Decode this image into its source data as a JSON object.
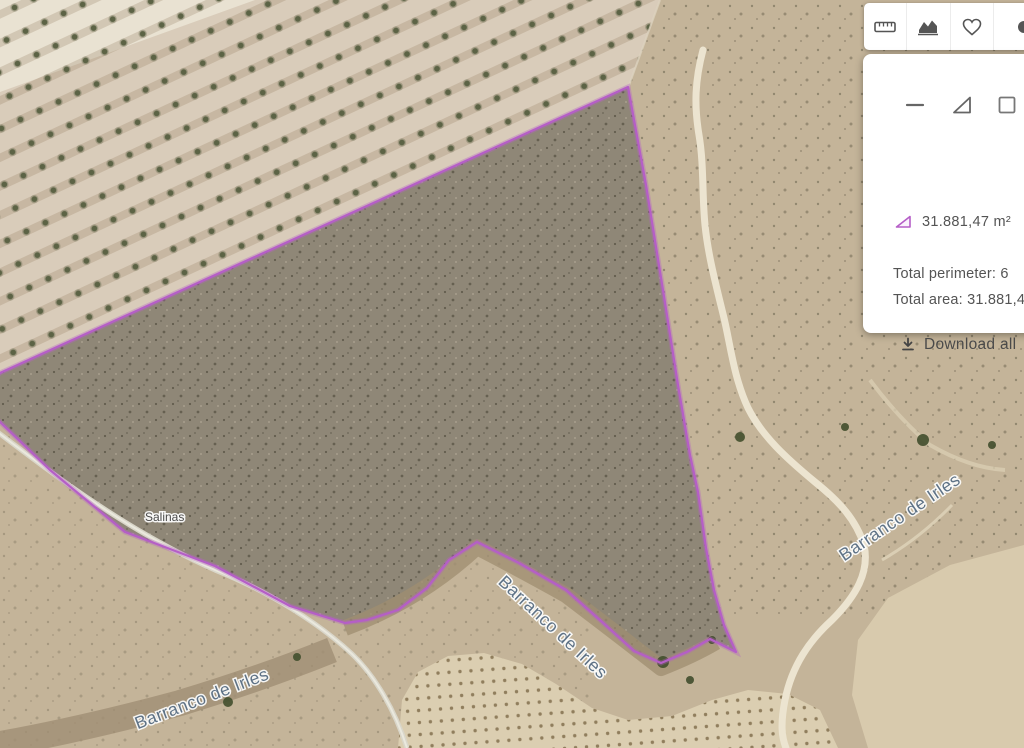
{
  "toolbar": {
    "icons": [
      "ruler-icon",
      "elevation-profile-icon",
      "favorite-heart-icon",
      "more-icon-partial"
    ]
  },
  "panel": {
    "tool_icons": [
      "line-measure-icon",
      "area-measure-icon",
      "rectangle-measure-icon"
    ],
    "measurement_value": "31.881,47 m²",
    "perimeter_text": "Total perimeter: 6",
    "area_text": "Total area: 31.881,47 m²",
    "download_label": "Download all",
    "accent_color": "#b55ec7"
  },
  "map": {
    "labels": {
      "place": "Salinas",
      "stream": "Barranco de Irles"
    },
    "outline_color": "#b55ec7",
    "parcel_points": "628,87 646,185 663,290 678,385 690,455 698,492 706,548 714,590 724,625 736,652 710,639 687,652 661,663 634,651 601,621 566,590 519,563 477,542 449,560 427,588 398,610 367,620 345,623 290,606 215,566 125,532 50,470 0,422 -28,398 0,373"
  }
}
